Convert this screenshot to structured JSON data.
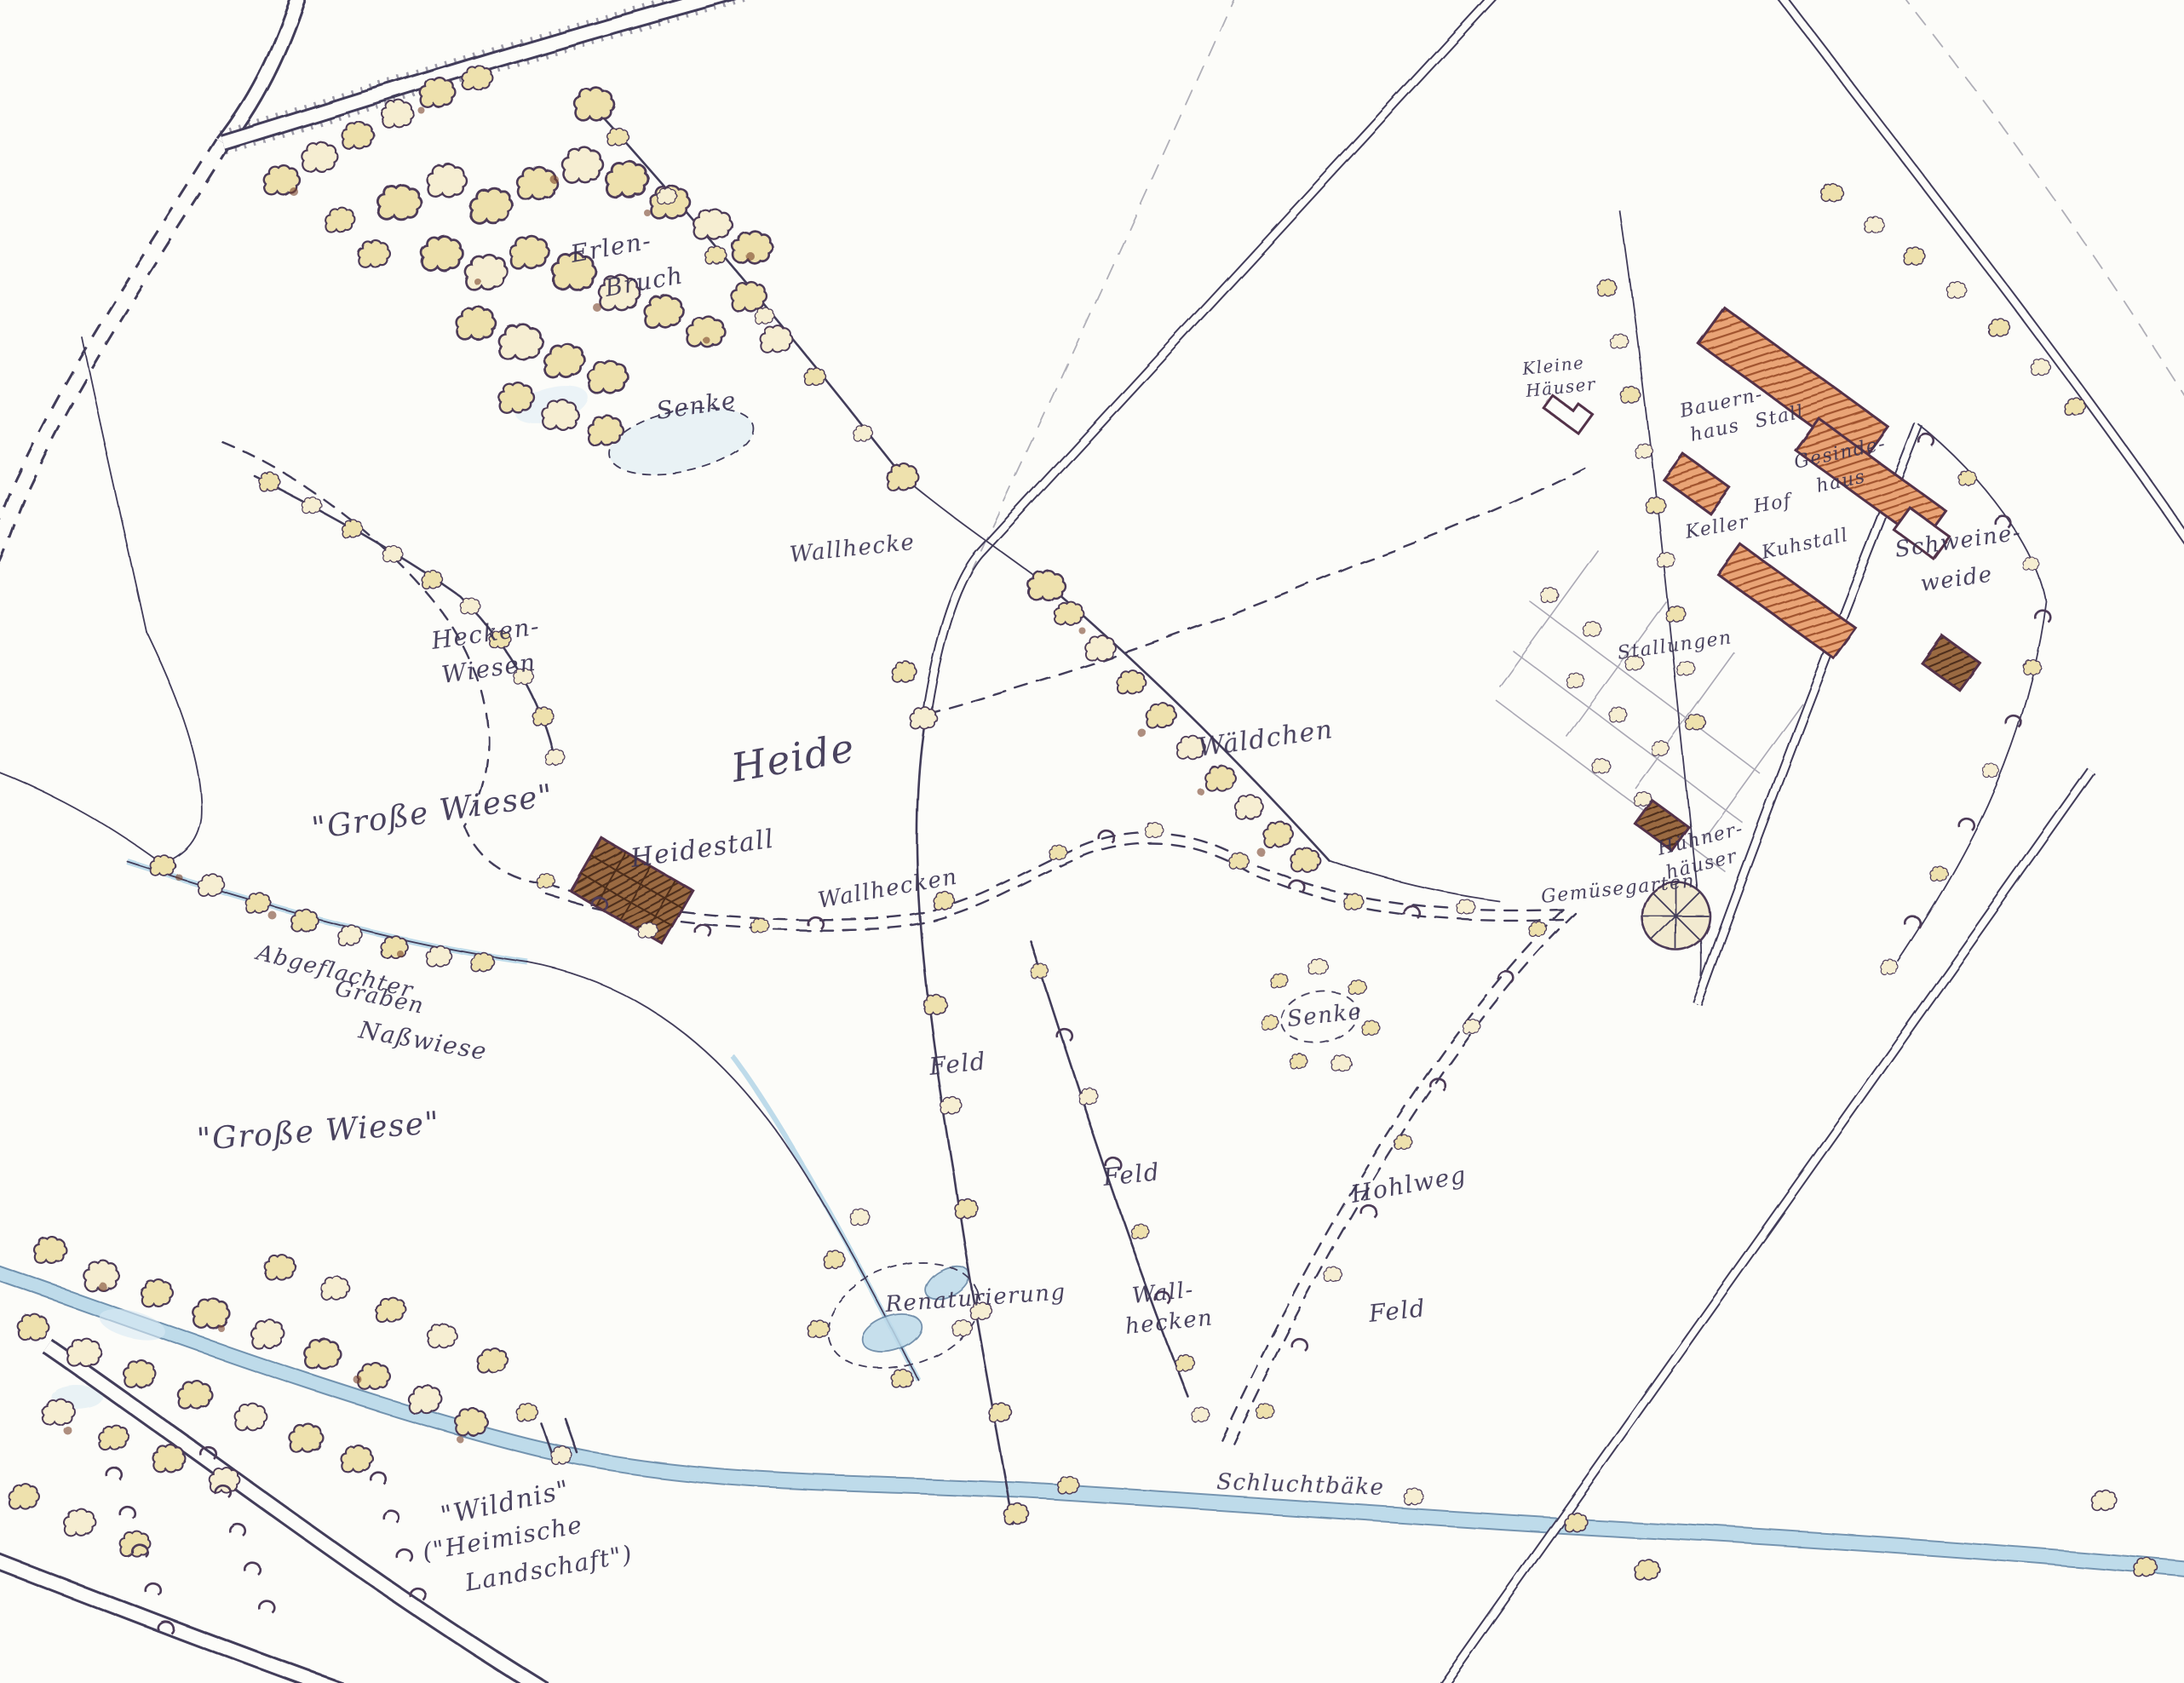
{
  "palette": {
    "paper": "#fcfcf9",
    "ink": "#423c5a",
    "tree_fill": "#eee1ad",
    "tree_fill_light": "#f6eed2",
    "tree_shadow_brown": "#7a452c",
    "building_orange": "#e9a476",
    "building_hatch": "#a0522d",
    "building_brown": "#9a6a42",
    "water_blue": "#b7d7e8"
  },
  "labels": [
    {
      "id": "erlen-bruch-line1",
      "text": "Erlen-"
    },
    {
      "id": "erlen-bruch-line2",
      "text": "Bruch"
    },
    {
      "id": "senke-north",
      "text": "Senke"
    },
    {
      "id": "wallhecke-north",
      "text": "Wallhecke"
    },
    {
      "id": "hecken-wiesen-line1",
      "text": "Hecken-"
    },
    {
      "id": "hecken-wiesen-line2",
      "text": "Wiesen"
    },
    {
      "id": "heide",
      "text": "Heide"
    },
    {
      "id": "grosse-wiese-north",
      "text": "\"Große Wiese\""
    },
    {
      "id": "heidestall",
      "text": "Heidestall"
    },
    {
      "id": "wallhecken-track",
      "text": "Wallhecken"
    },
    {
      "id": "waeldchen",
      "text": "Wäldchen"
    },
    {
      "id": "abgeflachter-graben-line1",
      "text": "Abgeflachter"
    },
    {
      "id": "abgeflachter-graben-line2",
      "text": "Graben"
    },
    {
      "id": "nasswiese",
      "text": "Naßwiese"
    },
    {
      "id": "grosse-wiese-south",
      "text": "\"Große Wiese\""
    },
    {
      "id": "feld-1",
      "text": "Feld"
    },
    {
      "id": "feld-2",
      "text": "Feld"
    },
    {
      "id": "senke-south",
      "text": "Senke"
    },
    {
      "id": "hohlweg",
      "text": "Hohlweg"
    },
    {
      "id": "feld-3",
      "text": "Feld"
    },
    {
      "id": "renaturierung",
      "text": "Renaturierung"
    },
    {
      "id": "wallhecken-south-line1",
      "text": "Wall-"
    },
    {
      "id": "wallhecken-south-line2",
      "text": "hecken"
    },
    {
      "id": "wildnis-line1",
      "text": "\"Wildnis\""
    },
    {
      "id": "wildnis-line2",
      "text": "(\"Heimische"
    },
    {
      "id": "wildnis-line3",
      "text": "Landschaft\")"
    },
    {
      "id": "schluchtbaeke",
      "text": "Schluchtbäke"
    },
    {
      "id": "kleine-haeuser-line1",
      "text": "Kleine"
    },
    {
      "id": "kleine-haeuser-line2",
      "text": "Häuser"
    },
    {
      "id": "bauernhaus-line1",
      "text": "Bauern-"
    },
    {
      "id": "bauernhaus-line2",
      "text": "haus"
    },
    {
      "id": "stall",
      "text": "Stall"
    },
    {
      "id": "gesindehaus-line1",
      "text": "Gesinde-"
    },
    {
      "id": "gesindehaus-line2",
      "text": "haus"
    },
    {
      "id": "hof",
      "text": "Hof"
    },
    {
      "id": "keller",
      "text": "Keller"
    },
    {
      "id": "kuhstall",
      "text": "Kuhstall"
    },
    {
      "id": "schweineweide-line1",
      "text": "Schweine-"
    },
    {
      "id": "schweineweide-line2",
      "text": "weide"
    },
    {
      "id": "stallungen",
      "text": "Stallungen"
    },
    {
      "id": "huehnerhaeuser-line1",
      "text": "Hühner-"
    },
    {
      "id": "huehnerhaeuser-line2",
      "text": "häuser"
    },
    {
      "id": "gemuesegarten",
      "text": "Gemüsegarten"
    }
  ]
}
